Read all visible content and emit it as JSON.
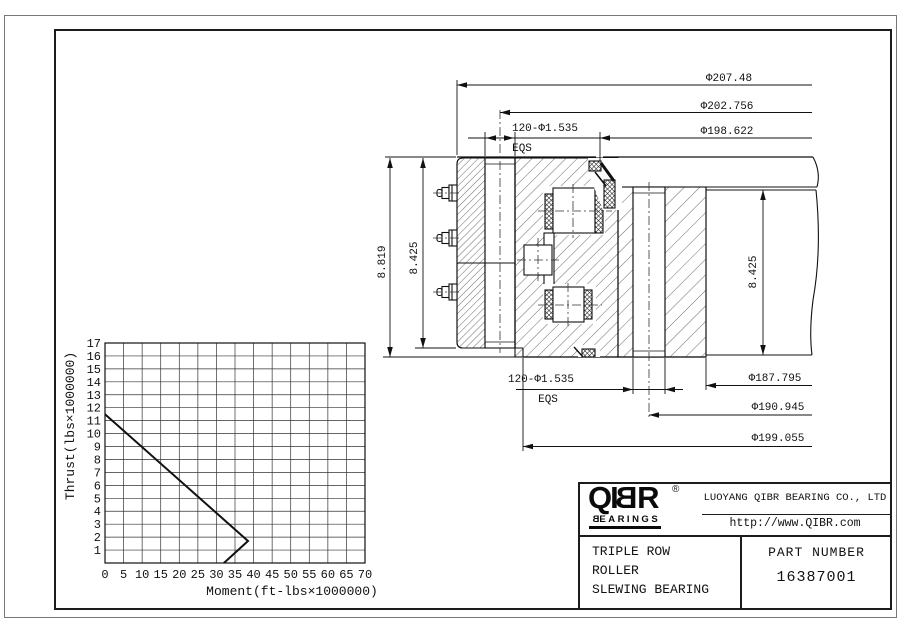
{
  "page": {
    "background": "#ffffff",
    "line_color": "#1c1c1c"
  },
  "section_view": {
    "dims_top": [
      {
        "label": "Φ207.48"
      },
      {
        "label": "Φ202.756"
      },
      {
        "label": "Φ198.622"
      }
    ],
    "bolt_dim_top": {
      "label": "120-Φ1.535",
      "note": "EQS"
    },
    "bolt_dim_bottom": {
      "label": "120-Φ1.535",
      "note": "EQS"
    },
    "dims_bottom": [
      {
        "label": "Φ187.795"
      },
      {
        "label": "Φ190.945"
      },
      {
        "label": "Φ199.055"
      }
    ],
    "dim_height_total": "8.819",
    "dim_height_inner": "8.425",
    "dim_height_outer": "8.425"
  },
  "chart_data": {
    "type": "line",
    "title": "",
    "xlabel": "Moment(ft-lbs×1000000)",
    "ylabel": "Thrust(lbs×1000000)",
    "xlim": [
      0,
      70
    ],
    "ylim": [
      0,
      17
    ],
    "x_ticks": [
      0,
      5,
      10,
      15,
      20,
      25,
      30,
      35,
      40,
      45,
      50,
      55,
      60,
      65,
      70
    ],
    "y_ticks": [
      1,
      2,
      3,
      4,
      5,
      6,
      7,
      8,
      9,
      10,
      11,
      12,
      13,
      14,
      15,
      16,
      17
    ],
    "grid": true,
    "legend": "none",
    "series": [
      {
        "name": "thrust-moment capacity curve",
        "points": [
          [
            0,
            11.5
          ],
          [
            38.5,
            1.7
          ],
          [
            32,
            0
          ]
        ]
      }
    ]
  },
  "title_block": {
    "logo": {
      "chars": [
        "Q",
        "I",
        "B",
        "R"
      ],
      "registered": "®",
      "tagline_first": "B",
      "tagline_rest": "EARINGS"
    },
    "company": "LUOYANG QIBR BEARING CO., LTD",
    "website": "http://www.QIBR.com",
    "product": [
      "TRIPLE ROW",
      "ROLLER",
      "SLEWING BEARING"
    ],
    "part_label": "PART NUMBER",
    "part_number": "16387001"
  }
}
